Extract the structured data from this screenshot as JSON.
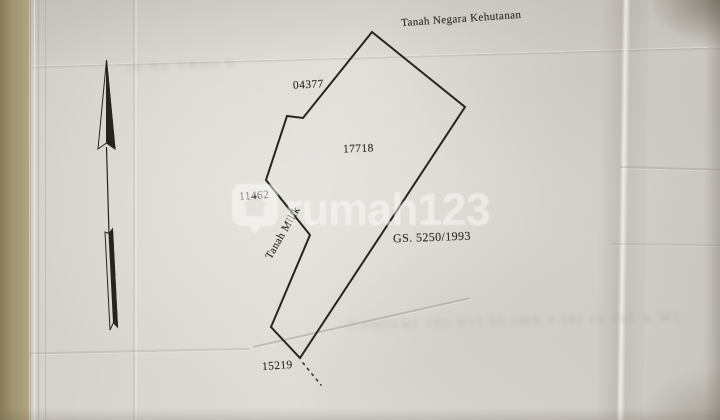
{
  "map": {
    "labels": {
      "tanah_negara": "Tanah Negara Kehutanan",
      "num_04377": "04377",
      "num_17718": "17718",
      "num_11462": "11462",
      "tanah_milik": "Tanah Milik",
      "gs_number": "GS. 5250/1993",
      "num_15219": "15219"
    },
    "geometry": {
      "parcel_polygon_points": "372,32 303,118 287,116 266,180 310,235 271,327 300,358 465,107",
      "dotted_line": {
        "x1": "303",
        "y1": "363",
        "x2": "321",
        "y2": "385"
      }
    }
  },
  "watermark": {
    "brand": "rumah123",
    "icon": "map-pin-house-icon",
    "color": "#ffffff"
  },
  "bleedthrough": {
    "top_text": "im Nw Vmnrt n",
    "bottom_text": "Gnmlxwr tnr wrl lx tmn r lnt tv txr n Wt"
  },
  "colors": {
    "paper": "#d8d5d0",
    "ink": "#26241f",
    "table_edge": "#a2956f"
  }
}
